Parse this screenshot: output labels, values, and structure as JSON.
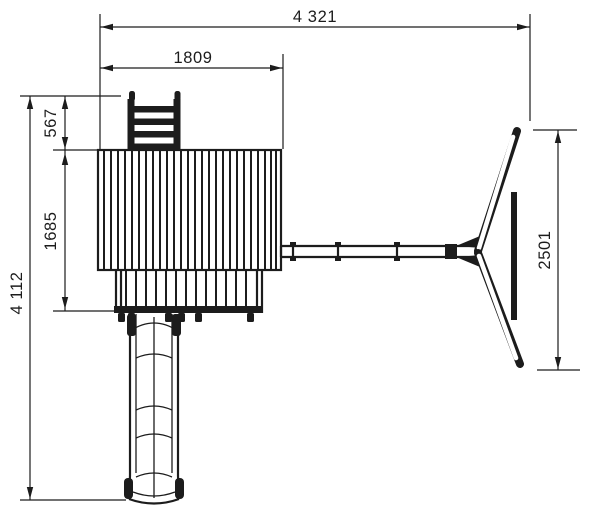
{
  "meta": {
    "background": "#ffffff",
    "line_color": "#1c1c1c"
  },
  "dimensions": {
    "overall_width": "4 321",
    "roof_width": "1809",
    "ladder_depth": "567",
    "deck_depth": "1685",
    "overall_depth": "4 112",
    "swing_span": "2501"
  }
}
